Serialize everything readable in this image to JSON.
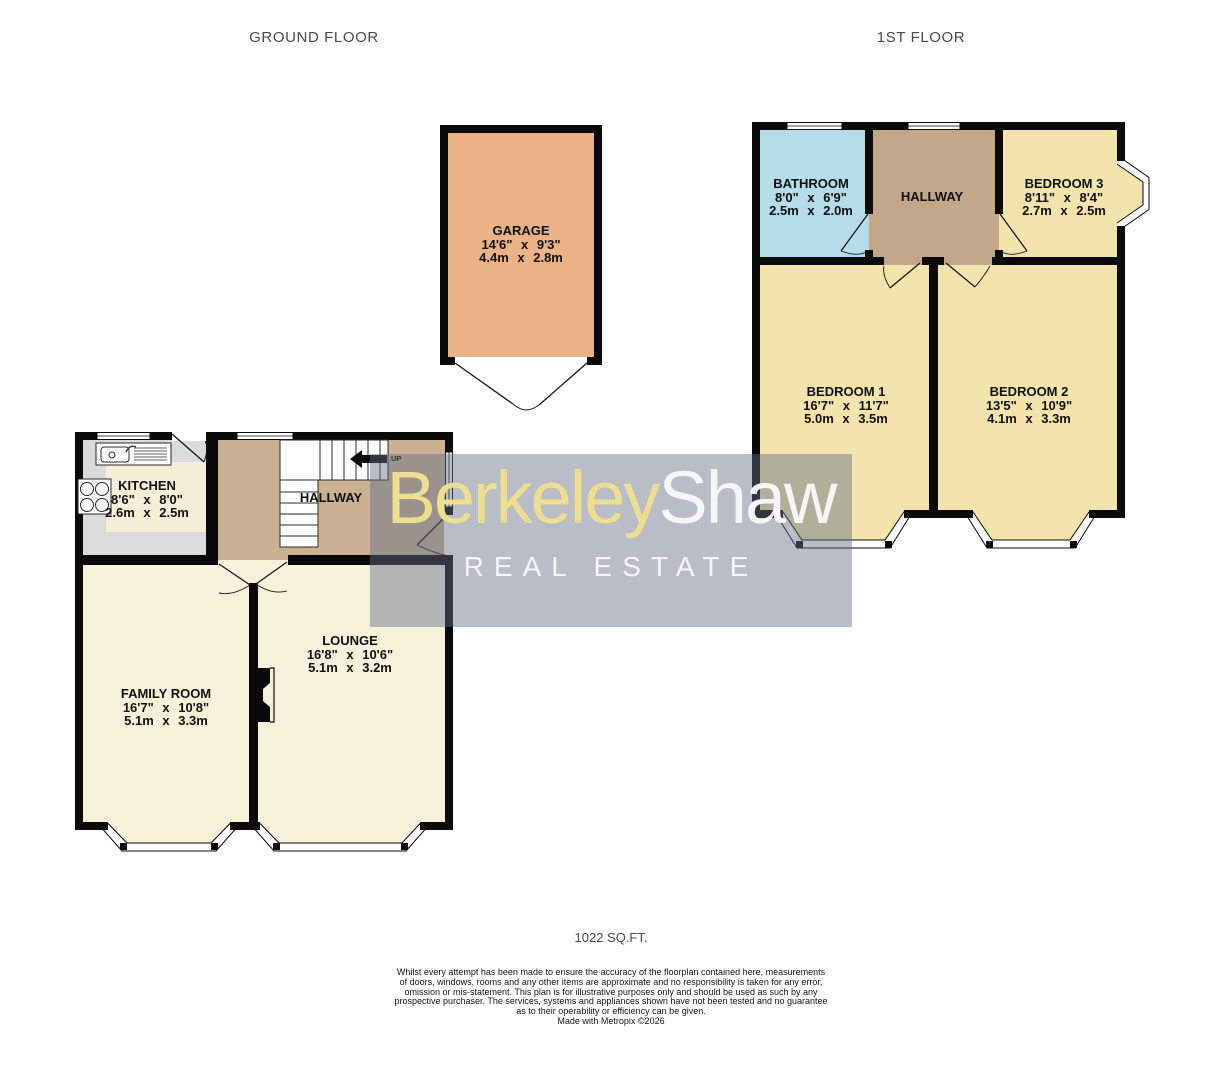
{
  "floor_titles": {
    "ground": "GROUND FLOOR",
    "first": "1ST FLOOR"
  },
  "rooms": {
    "garage": {
      "name": "GARAGE",
      "imperial": "14'6\" x 9'3\"",
      "metric": "4.4m x 2.8m"
    },
    "kitchen": {
      "name": "KITCHEN",
      "imperial": "8'6\" x 8'0\"",
      "metric": "2.6m x 2.5m"
    },
    "hallway_ground": {
      "name": "HALLWAY"
    },
    "family_room": {
      "name": "FAMILY ROOM",
      "imperial": "16'7\" x 10'8\"",
      "metric": "5.1m x 3.3m"
    },
    "lounge": {
      "name": "LOUNGE",
      "imperial": "16'8\" x 10'6\"",
      "metric": "5.1m x 3.2m"
    },
    "bathroom": {
      "name": "BATHROOM",
      "imperial": "8'0\" x 6'9\"",
      "metric": "2.5m x 2.0m"
    },
    "hallway_first": {
      "name": "HALLWAY"
    },
    "bedroom1": {
      "name": "BEDROOM 1",
      "imperial": "16'7\" x 11'7\"",
      "metric": "5.0m x 3.5m"
    },
    "bedroom2": {
      "name": "BEDROOM 2",
      "imperial": "13'5\" x 10'9\"",
      "metric": "4.1m x 3.3m"
    },
    "bedroom3": {
      "name": "BEDROOM 3",
      "imperial": "8'11\" x 8'4\"",
      "metric": "2.7m x 2.5m"
    }
  },
  "stairs": {
    "direction_label": "UP"
  },
  "watermark": {
    "brand_primary": "Berkeley",
    "brand_secondary": "Shaw",
    "tagline": "REAL ESTATE"
  },
  "footer": {
    "total_area": "1022 SQ.FT.",
    "disclaimer_lines": [
      "Whilst every attempt has been made to ensure the accuracy of the floorplan contained here, measurements",
      "of doors, windows, rooms and any other items are approximate and no responsibility is taken for any error,",
      "omission or mis-statement. This plan is for illustrative purposes only and should be used as such by any",
      "prospective purchaser. The services, systems and appliances shown have not been tested and no guarantee",
      "as to their operability or efficiency can be given.",
      "Made with Metropix ©2026"
    ]
  },
  "colors": {
    "wall": "#0a0a0a",
    "room_cream": "#F6F1DB",
    "room_yellow": "#F3E3AC",
    "hallway_tan_ground": "#C9B192",
    "hallway_tan_first": "#C3A788",
    "bathroom_blue": "#B4DCE9",
    "garage_orange": "#EAB287",
    "kitchen_gray": "#DBDBDB",
    "kitchen_counter": "#F5EFD9",
    "brand_yellow": "#EEDF90",
    "brand_white": "#F5F6F8"
  }
}
